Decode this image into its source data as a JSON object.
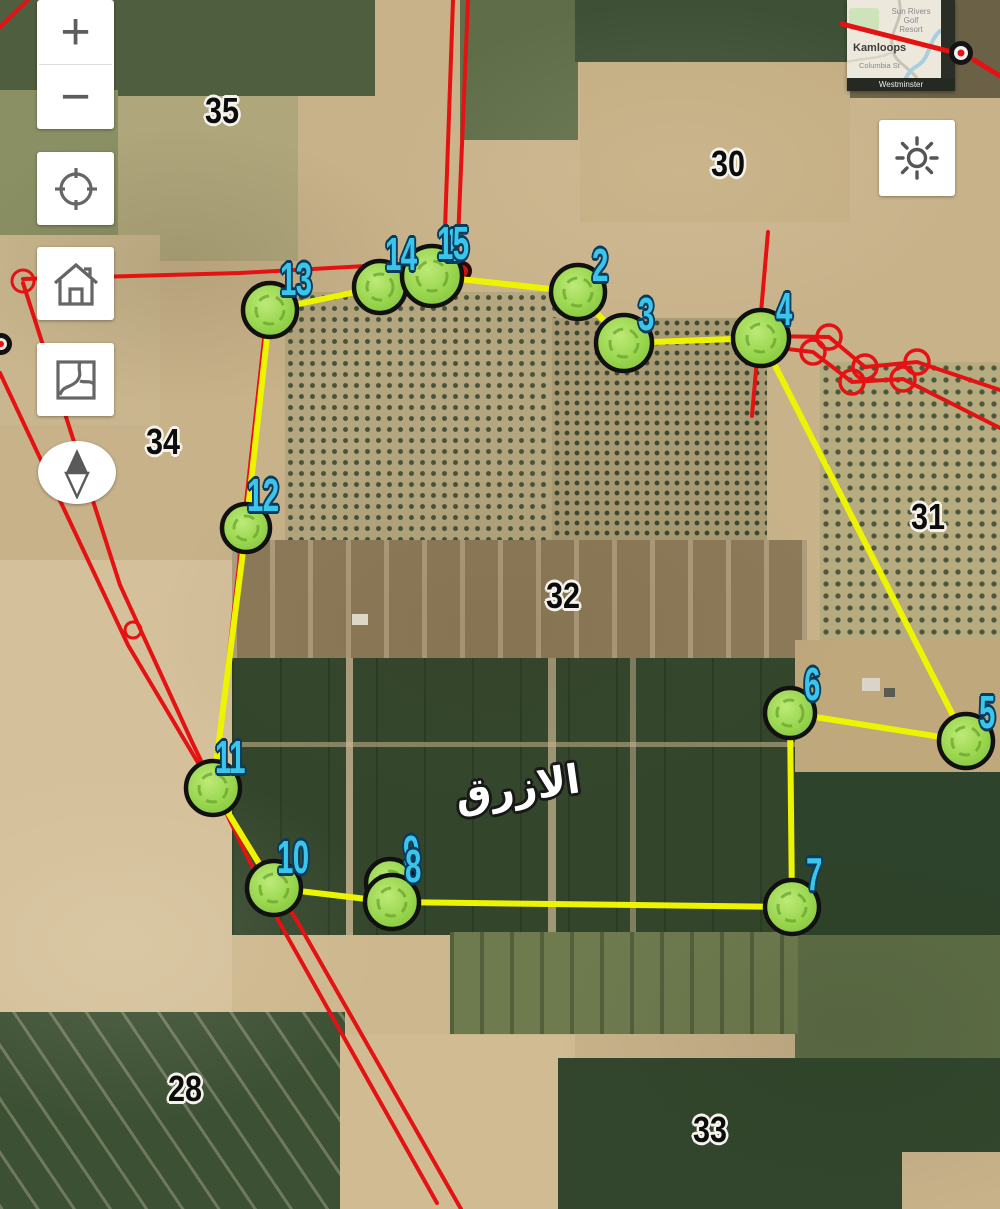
{
  "controls": {
    "zoom_in": "+",
    "zoom_out": "−"
  },
  "inset": {
    "city": "Kamloops",
    "poi_line1": "Sun Rivers Golf",
    "poi_line2": "Resort",
    "street": "Columbia St",
    "street_bottom": "Westminster"
  },
  "map": {
    "place_label": "الازرق",
    "parcel_labels": [
      {
        "label": "35",
        "x": 205,
        "y": 93
      },
      {
        "label": "30",
        "x": 711,
        "y": 146
      },
      {
        "label": "34",
        "x": 146,
        "y": 424
      },
      {
        "label": "32",
        "x": 546,
        "y": 578
      },
      {
        "label": "31",
        "x": 911,
        "y": 499
      },
      {
        "label": "28",
        "x": 168,
        "y": 1071
      },
      {
        "label": "33",
        "x": 693,
        "y": 1112
      }
    ],
    "vertex_labels": [
      {
        "label": "2",
        "mx": 578,
        "my": 292,
        "r": 27,
        "lx": 592,
        "ly": 244
      },
      {
        "label": "3",
        "mx": 624,
        "my": 343,
        "r": 28,
        "lx": 638,
        "ly": 293
      },
      {
        "label": "4",
        "mx": 761,
        "my": 338,
        "r": 28,
        "lx": 776,
        "ly": 288
      },
      {
        "label": "5",
        "mx": 966,
        "my": 741,
        "r": 27,
        "lx": 979,
        "ly": 691
      },
      {
        "label": "6",
        "mx": 790,
        "my": 713,
        "r": 25,
        "lx": 804,
        "ly": 663
      },
      {
        "label": "7",
        "mx": 792,
        "my": 907,
        "r": 27,
        "lx": 806,
        "ly": 853
      },
      {
        "label": "9",
        "mx": 390,
        "my": 883,
        "r": 24,
        "lx": 403,
        "ly": 831
      },
      {
        "label": "8",
        "mx": 392,
        "my": 902,
        "r": 27,
        "lx": 405,
        "ly": 845
      },
      {
        "label": "10",
        "mx": 274,
        "my": 888,
        "r": 27,
        "lx": 277,
        "ly": 836
      },
      {
        "label": "11",
        "mx": 213,
        "my": 788,
        "r": 27,
        "lx": 215,
        "ly": 736
      },
      {
        "label": "12",
        "mx": 246,
        "my": 528,
        "r": 24,
        "lx": 247,
        "ly": 474
      },
      {
        "label": "13",
        "mx": 270,
        "my": 310,
        "r": 27,
        "lx": 280,
        "ly": 258
      },
      {
        "label": "14",
        "mx": 380,
        "my": 287,
        "r": 26,
        "lx": 385,
        "ly": 233
      },
      {
        "label": "1",
        "mx": 432,
        "my": 276,
        "r": 0,
        "lx": 444,
        "ly": 224
      },
      {
        "label": "15",
        "mx": 432,
        "my": 276,
        "r": 30,
        "lx": 437,
        "ly": 222
      }
    ],
    "polygon_points": [
      [
        270,
        310
      ],
      [
        380,
        287
      ],
      [
        432,
        276
      ],
      [
        578,
        292
      ],
      [
        624,
        343
      ],
      [
        761,
        338
      ],
      [
        966,
        741
      ],
      [
        790,
        713
      ],
      [
        792,
        907
      ],
      [
        392,
        902
      ],
      [
        274,
        888
      ],
      [
        213,
        788
      ],
      [
        246,
        528
      ]
    ],
    "colors": {
      "parcel_boundary_yellow": "#edf402",
      "cadastral_red": "#e41212",
      "marker_fill": "#9ad64f",
      "marker_stroke": "#111111",
      "vertex_label_cyan": "#3ac6ea"
    }
  }
}
